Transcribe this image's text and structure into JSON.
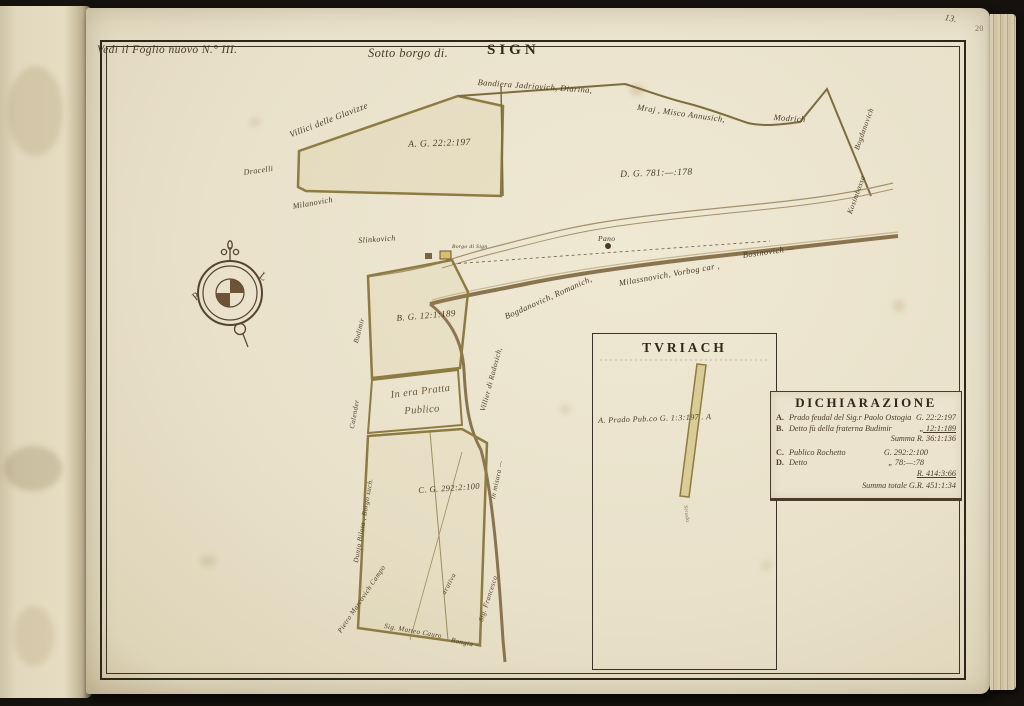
{
  "book": {
    "folio_ink": "13.",
    "folio_pencil": "20"
  },
  "map": {
    "reference_note": "Vedi il Foglio nuovo N.° III.",
    "title_prefix": "Sotto borgo di.",
    "title_main": "SIGN",
    "compass": {
      "west": "P",
      "east": "L"
    },
    "parcel_labels": {
      "a": "A. G. 22:2:197",
      "d": "D. G. 781:—:178",
      "b": "B. G. 12:1:189",
      "pratto_line1": "In era Pratta",
      "pratto_line2": "Publico",
      "c": "C. G. 292:2:100"
    },
    "labels": [
      {
        "text": "Villici delle Glavizze"
      },
      {
        "text": "Bandiera Jadriovich, Diarina,"
      },
      {
        "text": "Mraj , Misco Annusich,"
      },
      {
        "text": "Modrich"
      },
      {
        "text": "Dracelli"
      },
      {
        "text": "Milanovich"
      },
      {
        "text": "Slinkovich"
      },
      {
        "text": "Bogdanovich"
      },
      {
        "text": "Kosimbassa"
      },
      {
        "text": "Pano"
      },
      {
        "text": "Borgo di Sign"
      },
      {
        "text": "Villier di Radosich,"
      },
      {
        "text": "Bogdanovich, Romanich,"
      },
      {
        "text": "Milassnovich, Vorbog car ,"
      },
      {
        "text": "Bosinovich —"
      },
      {
        "text": "Budimir"
      },
      {
        "text": "Calender"
      },
      {
        "text": "Dunja Bilota , Borgo such."
      },
      {
        "text": "Pietro Marcovich Campo"
      },
      {
        "text": "Sig. Matteo Cauro"
      },
      {
        "text": "Bongia —"
      },
      {
        "text": "Sig. Francesco"
      },
      {
        "text": "in misura —"
      },
      {
        "text": "arativa"
      }
    ]
  },
  "inset": {
    "title": "TVRIACH",
    "parcel_label": "A. Prado Pub.co G. 1:3:197 . A",
    "strip_label": "Strada"
  },
  "legend": {
    "title": "DICHIARAZIONE",
    "rows": [
      {
        "letter": "A.",
        "desc": "Prado feudal del Sig.r Paolo Ostogia",
        "value": "G. 22:2:197"
      },
      {
        "letter": "B.",
        "desc": "Detto fù della fraterna Budimir",
        "value": "„ 12:1:189"
      },
      {
        "letter": "",
        "desc": "",
        "value": "Summa R. 36:1:136"
      },
      {
        "letter": "C.",
        "desc": "Publico Rochetto",
        "value": "G. 292:2:100"
      },
      {
        "letter": "D.",
        "desc": "Detto",
        "value": "„ 78:—:78"
      },
      {
        "letter": "",
        "desc": "",
        "value": "R. 414:3:66"
      },
      {
        "letter": "",
        "desc": "",
        "value": "Summa totale G.R. 451:1:34"
      }
    ]
  }
}
